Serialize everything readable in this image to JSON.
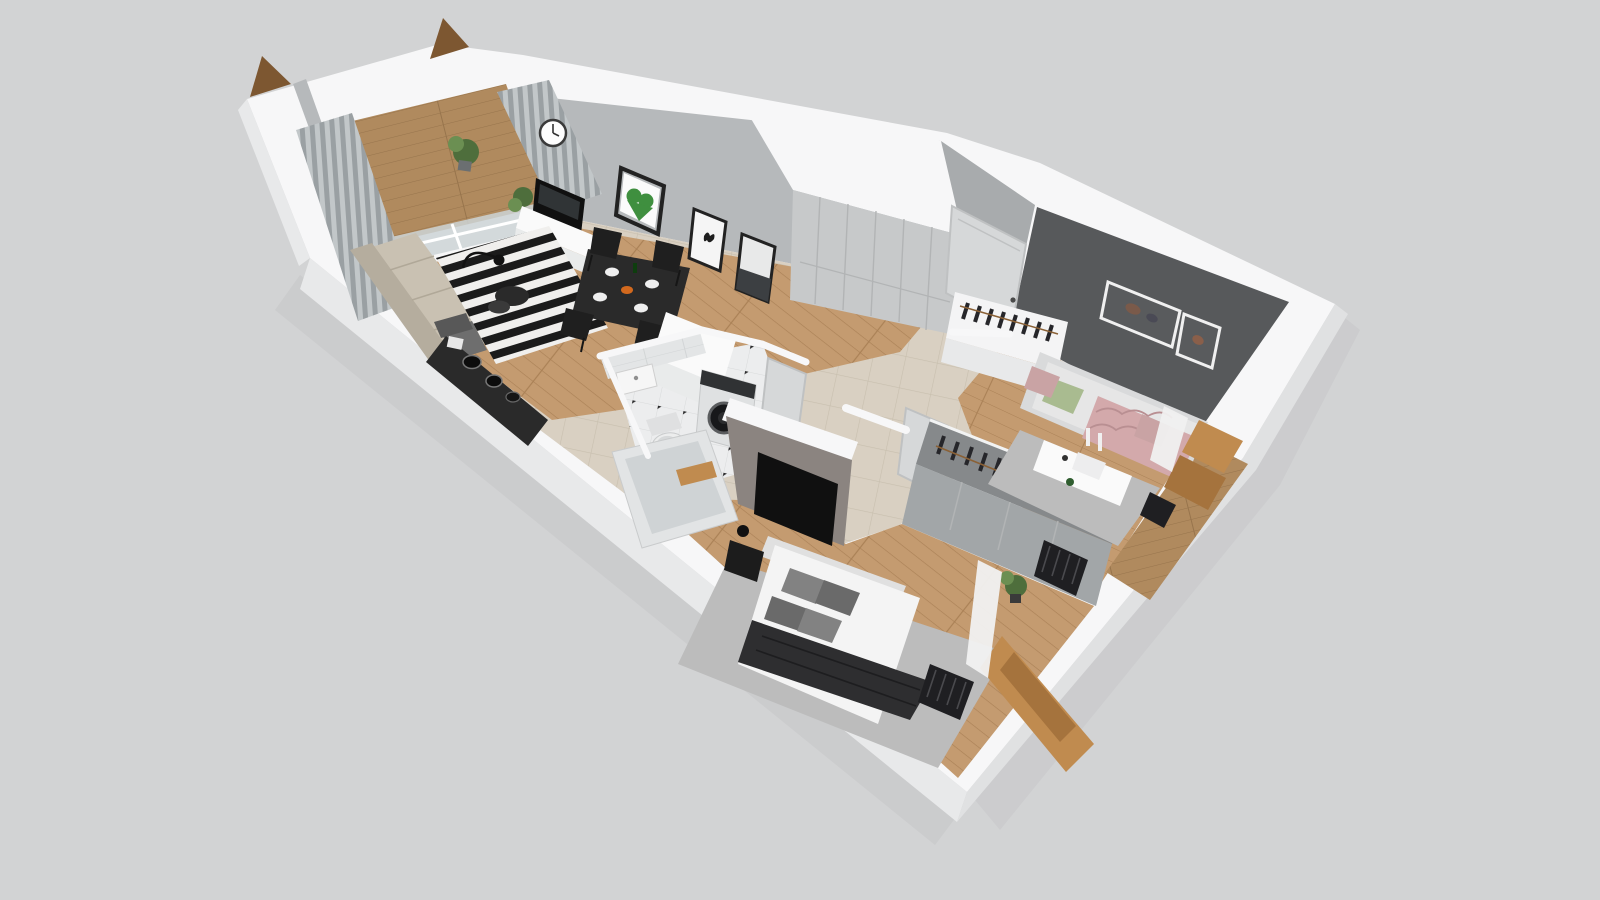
{
  "scene": {
    "title": "3D isometric cutaway floor plan of a one-bedroom apartment",
    "view": "axonometric top-down cutaway, walls cut white",
    "background": "#d2d3d4"
  },
  "rooms": [
    {
      "id": "balcony",
      "label": "Balcony",
      "floor": "wood deck"
    },
    {
      "id": "living-room",
      "label": "Living room",
      "floor": "oak planks"
    },
    {
      "id": "kitchen",
      "label": "Kitchen",
      "floor": "beige tile"
    },
    {
      "id": "hallway",
      "label": "Hallway",
      "floor": "beige tile"
    },
    {
      "id": "bathroom",
      "label": "Bathroom",
      "floor": "white tile with black diamonds"
    },
    {
      "id": "bedroom",
      "label": "Bedroom",
      "floor": "oak planks"
    },
    {
      "id": "kids-room",
      "label": "Second room",
      "floor": "oak planks"
    }
  ],
  "furniture": [
    "curtains",
    "sliding-glass-door",
    "wall-clock",
    "tv",
    "tv-console",
    "potted-plant",
    "green-heart-art",
    "butterfly-art",
    "dark-abstract-art",
    "sofa",
    "striped-rug",
    "coffee-table",
    "floor-lamp",
    "armchair",
    "dining-table",
    "dining-chairs",
    "kitchen-counter",
    "cooktop-pots",
    "fridge-freezer",
    "hallway-wardrobe",
    "entry-door",
    "washing-machine",
    "toilet",
    "bathtub",
    "washbasin",
    "bathroom-door",
    "double-bed",
    "gray-pillows",
    "dark-blanket",
    "bedroom-rug",
    "nightstand",
    "bedside-lamp",
    "bedroom-wardrobe-with-clothes",
    "wall-tv-panel",
    "radiators",
    "oak-window-frames",
    "daybed",
    "floral-blanket",
    "green-pillow",
    "pink-pillow",
    "desk",
    "desk-chair",
    "clothes-rack",
    "picture-frames",
    "accent-wall"
  ],
  "palette": {
    "background": "#d2d3d4",
    "shadow": "#c3c4c6",
    "wall_top": "#f7f7f8",
    "wall_outer": "#e8e9ea",
    "wall_outer2": "#e0e1e2",
    "wall_face": "#b6b9bb",
    "wall_face_dark": "#a8abad",
    "accent_wall": "#57595b",
    "greige_wall": "#8b8480",
    "wood_floor": "#c49b70",
    "wood_line": "#aa8156",
    "deck_wood": "#b08a5e",
    "deck_line": "#97744c",
    "tile_floor": "#d9d0c2",
    "tile_line": "#c8bfae",
    "bath_floor": "#ecedee",
    "bath_tile_line": "#d8dadb",
    "bath_wall": "#e3e5e6",
    "glass": "#ccd3d6",
    "curtain": "#9aa0a3",
    "curtain_light": "#c2c7c9",
    "rug_black": "#1b1b1b",
    "rug_white": "#f0efed",
    "gray_rug": "#bcbcbc",
    "sofa": "#c9c1b2",
    "sofa_dark": "#b5ad9e",
    "dark_furniture": "#2a2a2a",
    "tv_black": "#101010",
    "console_white": "#fafafa",
    "console_shade": "#e9ebeb",
    "wardrobe_gray": "#a2a6a8",
    "wardrobe_top": "#86898b",
    "wardrobe_light": "#c7c9ca",
    "wardrobe_seam": "#b2b4b5",
    "clothes_dark": "#26262a",
    "hanger_brown": "#8a6136",
    "bed_white": "#f4f4f4",
    "bed_shade": "#e0e0e0",
    "blanket_dark": "#2e2e30",
    "pillow_gray": "#828282",
    "pillow_gray_dark": "#6a6a6a",
    "pillow_green": "#a9bb90",
    "pillow_pink": "#c9a3a4",
    "daybed_blanket": "#d3a9ab",
    "daybed_pattern": "#b98f92",
    "oak": "#c08b4f",
    "oak_dark": "#a5733d",
    "plant_green": "#4e6e3c",
    "plant_green_light": "#6b8f52",
    "door_white": "#d6d8d9",
    "door_edge": "#bfc1c2",
    "radiator_black": "#1f1f22",
    "triangle_brown": "#7d5731",
    "art_green": "#3f8f3f",
    "frame_dark": "#222222",
    "frame_white": "#f0f0f0",
    "white": "#ffffff",
    "ink": "#2a2a2b"
  }
}
